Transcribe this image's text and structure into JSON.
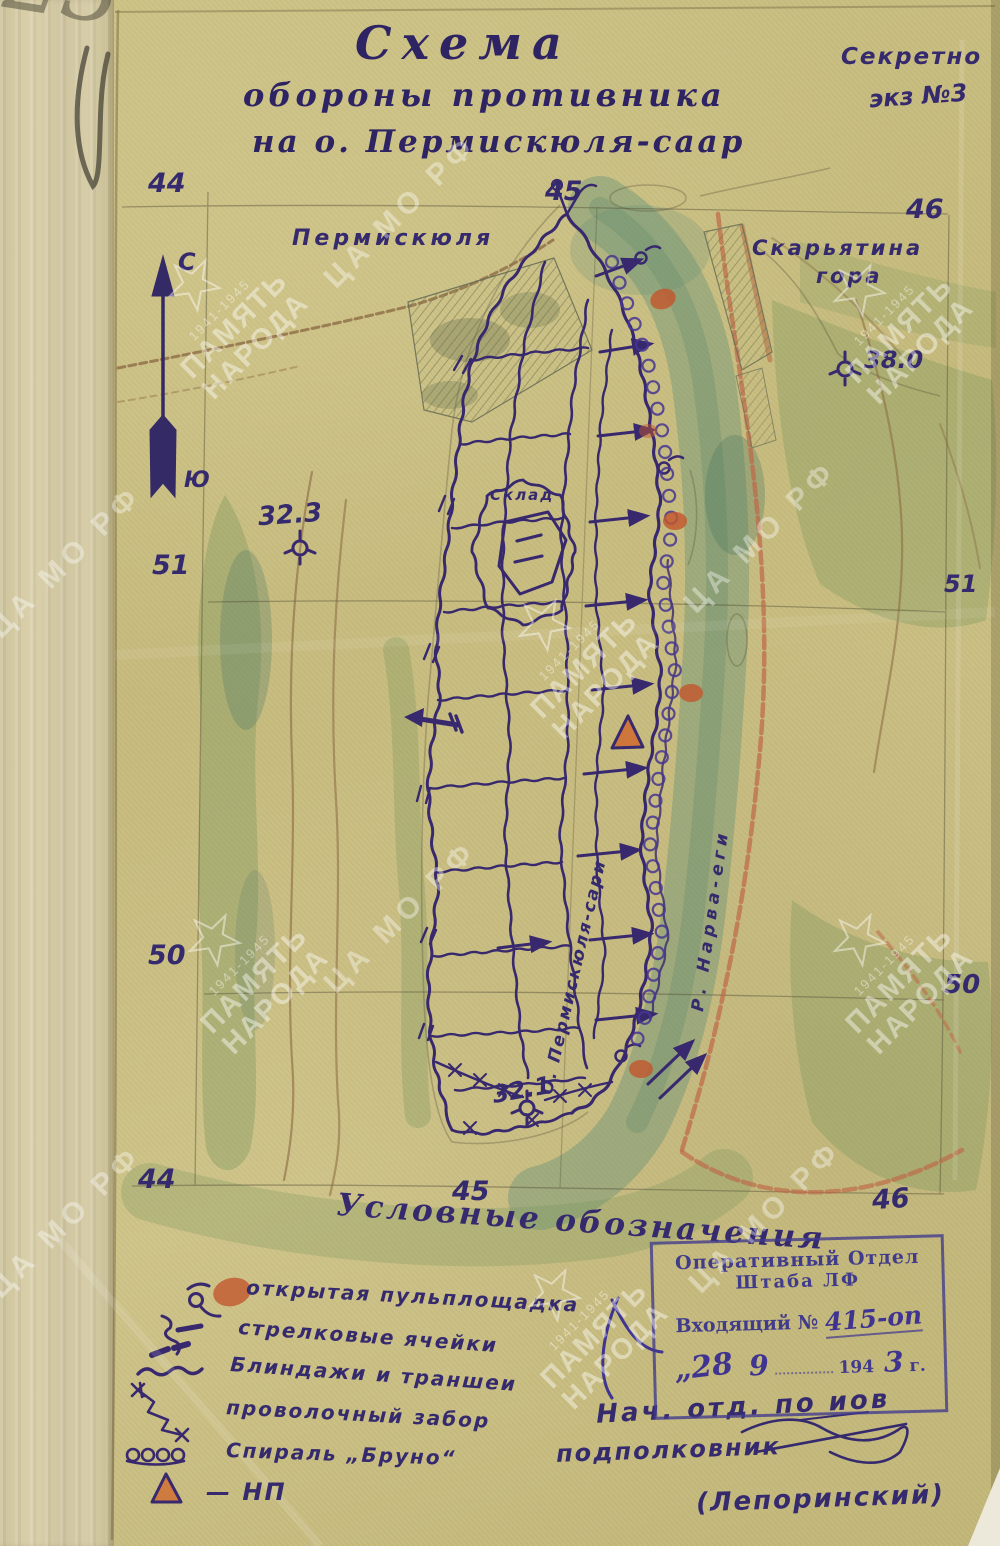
{
  "title": {
    "line1": "Схема",
    "line2": "обороны противника",
    "line3": "на о. Пермискюля-саар"
  },
  "classification": {
    "secret": "Секретно",
    "copy": "экз №3",
    "pencil_copy": "23"
  },
  "grid": {
    "top": [
      "44",
      "45",
      "46"
    ],
    "bottom": [
      "44",
      "45",
      "46"
    ],
    "left": [
      "51",
      "50"
    ],
    "right": [
      "51",
      "50"
    ]
  },
  "compass": {
    "north": "С",
    "south": "Ю"
  },
  "map_labels": {
    "village_west": "Пермискюля",
    "hill_east_line1": "Скарьятина",
    "hill_east_line2": "гора",
    "warehouse": "Склад",
    "island": "О. Пермискюля-сари",
    "river": "Р. Нарва-еги"
  },
  "elevations": {
    "west": "32.3",
    "east": "38.0",
    "south": "32.1"
  },
  "legend": {
    "heading": "Условные обозначения",
    "items": [
      {
        "symbol": "open-mg-platform",
        "label": "открытая пульплощадка"
      },
      {
        "symbol": "rifle-cells",
        "label": "стрелковые ячейки"
      },
      {
        "symbol": "dugouts-trenches",
        "label": "Блиндажи и траншеи"
      },
      {
        "symbol": "wire-fence",
        "label": "проволочный забор"
      },
      {
        "symbol": "bruno-spiral",
        "label": "Спираль „Бруно“"
      },
      {
        "symbol": "observation-post",
        "label": "— НП"
      }
    ]
  },
  "stamp": {
    "line1": "Оперативный Отдел",
    "line2": "Штаба ЛФ",
    "incoming_label": "Входящий №",
    "incoming_number": "415-оп",
    "day": "„28",
    "month": "9",
    "year_printed": "194",
    "year_hand": "3",
    "year_suffix": "г."
  },
  "signature": {
    "line1": "Нач. отд. по иов",
    "line2": "подполковник",
    "line3": "(Лепоринский)"
  },
  "watermarks": {
    "memory_line1": "ПАМЯТЬ",
    "memory_line2": "НАРОДА",
    "years": "1941-1945",
    "archive": "ЦА МО РФ"
  },
  "colors": {
    "ink": "#38296e",
    "stamp_ink": "#413b8c",
    "orange_accent": "#c2572e",
    "green_wash": "#6f9157",
    "river_wash": "#5d8f77",
    "paper": "#c7bb80"
  }
}
